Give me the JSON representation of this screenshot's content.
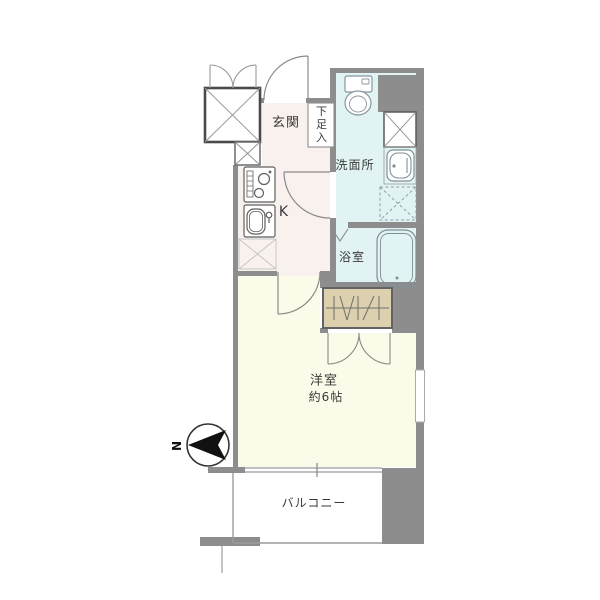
{
  "floor_plan": {
    "labels": {
      "entrance": "玄関",
      "shoe_cabinet": "下足入",
      "washroom": "洗面所",
      "bathroom": "浴室",
      "kitchen": "K",
      "main_room_name": "洋室",
      "main_room_size": "約6帖",
      "balcony": "バルコニー",
      "compass_north": "N"
    },
    "colors": {
      "wall": "#8d8d8d",
      "entrance_kitchen_floor": "#f8f1ee",
      "wet_area_floor": "#e2f3f3",
      "main_room_floor": "#fafbe8",
      "closet_fill": "#ddd0ae",
      "balcony_floor": "#ffffff",
      "compass_arrow": "#111111",
      "fixture_line": "#8a8a8a"
    },
    "icons": {
      "elevator": "crossed-box-icon",
      "pipe_shaft": "crossed-box-icon",
      "washing_machine_space": "dashed-crossed-box-icon",
      "refrigerator_space": "light-crossed-box-icon",
      "toilet": "toilet-icon",
      "washbasin": "washbasin-icon",
      "bathtub": "bathtub-icon",
      "stove": "stove-icon",
      "kitchen_sink": "sink-icon",
      "closet_hanger": "hanger-hatch-icon",
      "north_arrow": "compass-arrow-icon"
    }
  }
}
